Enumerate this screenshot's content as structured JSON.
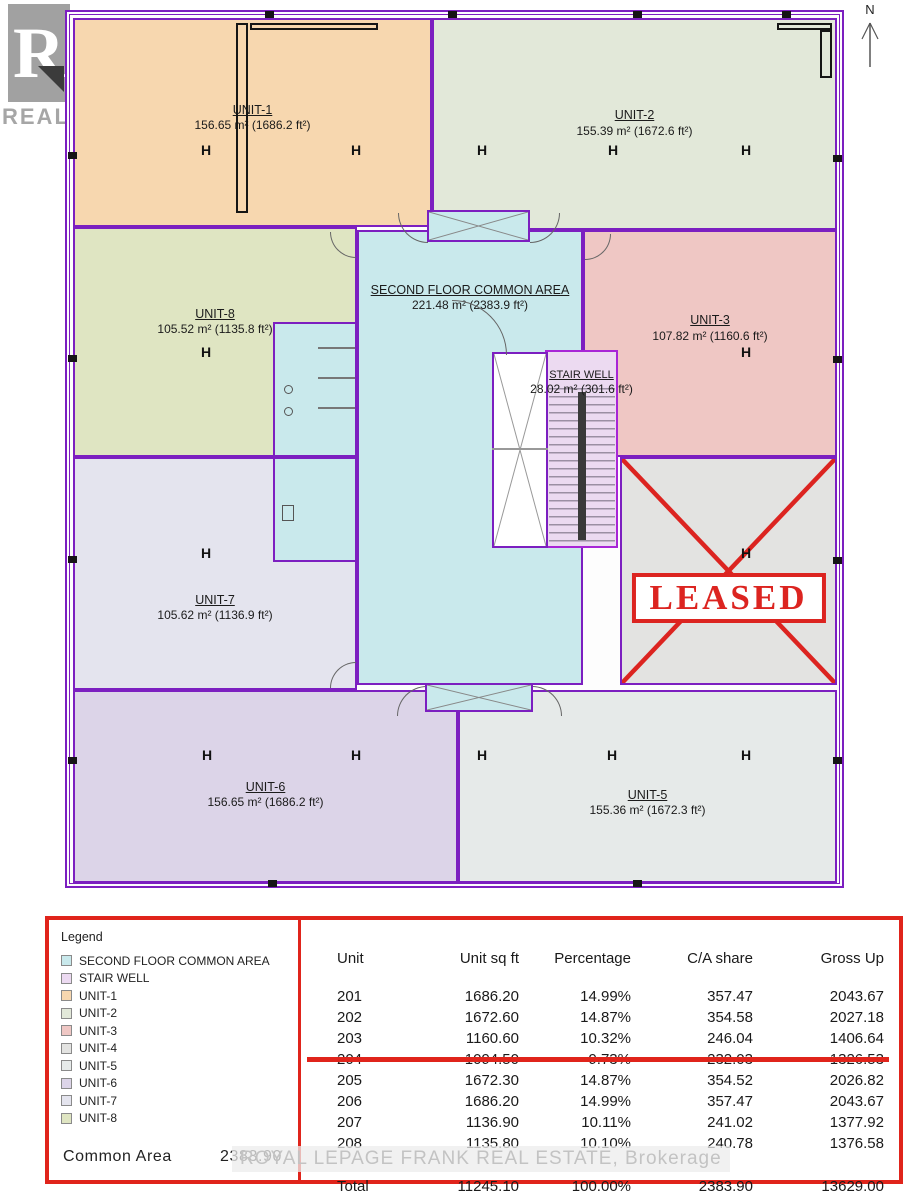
{
  "north": {
    "label": "N"
  },
  "watermarks": {
    "realtor_logo_letter": "R",
    "realtor_text": "REALTOR®",
    "brokerage": "ROYAL LEPAGE FRANK REAL ESTATE, Brokerage"
  },
  "colors": {
    "wall": "#7c1fc0",
    "accent_red": "#e0241b"
  },
  "floorplan": {
    "column_marker_glyph": "H",
    "leased_label": "LEASED",
    "rooms": [
      {
        "id": "unit-1",
        "name": "UNIT-1",
        "area": "156.65 m² (1686.2 ft²)"
      },
      {
        "id": "unit-2",
        "name": "UNIT-2",
        "area": "155.39 m² (1672.6 ft²)"
      },
      {
        "id": "unit-3",
        "name": "UNIT-3",
        "area": "107.82 m² (1160.6 ft²)"
      },
      {
        "id": "unit-4",
        "name": "",
        "area": ""
      },
      {
        "id": "unit-5",
        "name": "UNIT-5",
        "area": "155.36 m² (1672.3 ft²)"
      },
      {
        "id": "unit-6",
        "name": "UNIT-6",
        "area": "156.65 m² (1686.2 ft²)"
      },
      {
        "id": "unit-7",
        "name": "UNIT-7",
        "area": "105.62 m² (1136.9 ft²)"
      },
      {
        "id": "unit-8",
        "name": "UNIT-8",
        "area": "105.52 m² (1135.8 ft²)"
      },
      {
        "id": "common",
        "name": "SECOND FLOOR COMMON AREA",
        "area": "221.48 m² (2383.9 ft²)"
      },
      {
        "id": "stairwell",
        "name": "STAIR WELL",
        "area": "28.02 m² (301.6 ft²)"
      }
    ]
  },
  "legend": {
    "title": "Legend",
    "items": [
      {
        "id": "common",
        "label": "SECOND FLOOR COMMON AREA",
        "color": "#c9e9ec"
      },
      {
        "id": "stairwell",
        "label": "STAIR WELL",
        "color": "#ecdaf1"
      },
      {
        "id": "unit-1",
        "label": "UNIT-1",
        "color": "#f7d7af"
      },
      {
        "id": "unit-2",
        "label": "UNIT-2",
        "color": "#e2e8d9"
      },
      {
        "id": "unit-3",
        "label": "UNIT-3",
        "color": "#efc7c4"
      },
      {
        "id": "unit-4",
        "label": "UNIT-4",
        "color": "#e3e3e1"
      },
      {
        "id": "unit-5",
        "label": "UNIT-5",
        "color": "#e6eae9"
      },
      {
        "id": "unit-6",
        "label": "UNIT-6",
        "color": "#dcd4e8"
      },
      {
        "id": "unit-7",
        "label": "UNIT-7",
        "color": "#e4e4ee"
      },
      {
        "id": "unit-8",
        "label": "UNIT-8",
        "color": "#dfe5c2"
      }
    ],
    "common_area_label": "Common Area",
    "common_area_value": "2383.90"
  },
  "table": {
    "columns": [
      "Unit",
      "Unit sq ft",
      "Percentage",
      "C/A share",
      "Gross Up"
    ],
    "rows": [
      {
        "values": [
          "201",
          "1686.20",
          "14.99%",
          "357.47",
          "2043.67"
        ],
        "struck": false
      },
      {
        "values": [
          "202",
          "1672.60",
          "14.87%",
          "354.58",
          "2027.18"
        ],
        "struck": false
      },
      {
        "values": [
          "203",
          "1160.60",
          "10.32%",
          "246.04",
          "1406.64"
        ],
        "struck": false
      },
      {
        "values": [
          "204",
          "1094.50",
          "9.73%",
          "232.03",
          "1326.53"
        ],
        "struck": true
      },
      {
        "values": [
          "205",
          "1672.30",
          "14.87%",
          "354.52",
          "2026.82"
        ],
        "struck": false
      },
      {
        "values": [
          "206",
          "1686.20",
          "14.99%",
          "357.47",
          "2043.67"
        ],
        "struck": false
      },
      {
        "values": [
          "207",
          "1136.90",
          "10.11%",
          "241.02",
          "1377.92"
        ],
        "struck": false
      },
      {
        "values": [
          "208",
          "1135.80",
          "10.10%",
          "240.78",
          "1376.58"
        ],
        "struck": false
      }
    ],
    "total": {
      "values": [
        "Total",
        "11245.10",
        "100.00%",
        "2383.90",
        "13629.00"
      ]
    }
  }
}
